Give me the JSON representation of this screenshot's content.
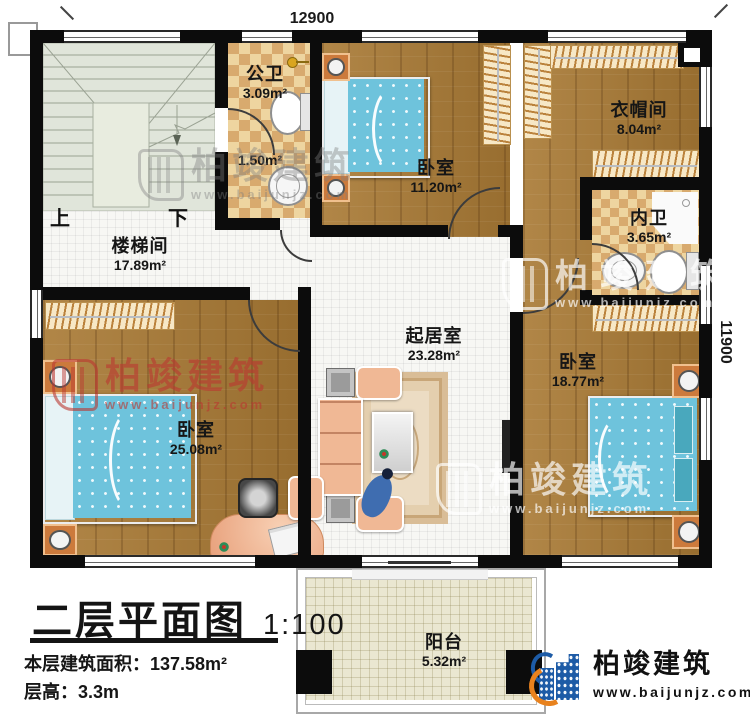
{
  "title_block": {
    "title": "二层平面图",
    "scale": "1:100",
    "area_label": "本层建筑面积：",
    "area_value": "137.58m²",
    "floor_height_label": "层高：",
    "floor_height_value": "3.3m"
  },
  "dimensions": {
    "top": "12900",
    "right": "11900"
  },
  "stairs": {
    "up": "上",
    "down": "下"
  },
  "rooms": {
    "stairwell": {
      "name": "楼梯间",
      "area": "17.89m²"
    },
    "public_bath": {
      "name": "公卫",
      "area": "3.09m²"
    },
    "wash_area": {
      "area": "1.50m²"
    },
    "bedroom_top": {
      "name": "卧室",
      "area": "11.20m²"
    },
    "cloakroom": {
      "name": "衣帽间",
      "area": "8.04m²"
    },
    "ensuite_bath": {
      "name": "内卫",
      "area": "3.65m²"
    },
    "bedroom_right": {
      "name": "卧室",
      "area": "18.77m²"
    },
    "living_room": {
      "name": "起居室",
      "area": "23.28m²"
    },
    "bedroom_left": {
      "name": "卧室",
      "area": "25.08m²"
    },
    "balcony": {
      "name": "阳台",
      "area": "5.32m²"
    }
  },
  "watermark": {
    "brand": "柏竣建筑",
    "url": "www.baijunjz.com"
  },
  "logo": {
    "brand": "柏竣建筑",
    "url": "www.baijunjz.com"
  },
  "colors": {
    "wall": "#0c0c0c",
    "wood": "#a97a35",
    "checker_light": "#eed5a0",
    "checker_dark": "#d8aa6e",
    "stair_floor": "#e0e5da",
    "balcony_tile": "#eae7d1",
    "bed_blue": "#6ec3dc",
    "watermark_red": "#ba3730",
    "logo_blue": "#1d5ba6",
    "logo_orange": "#e8821e"
  }
}
